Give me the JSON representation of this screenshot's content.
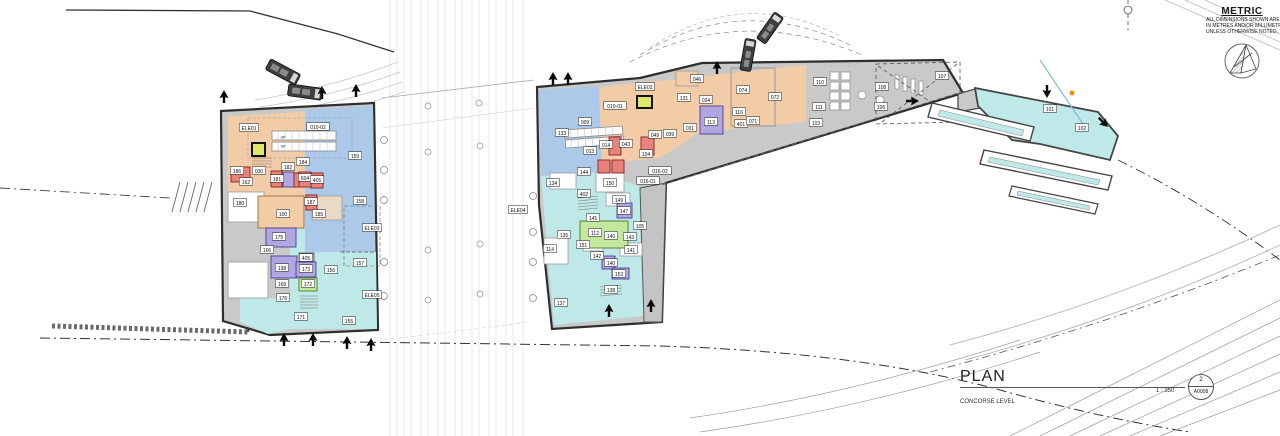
{
  "metric": {
    "title": "METRIC",
    "lines": [
      "ALL DIMENSIONS SHOWN ARE",
      "IN METRES AND/OR MILLIMETRES",
      "UNLESS OTHERWISE NOTED."
    ]
  },
  "title_block": {
    "title": "PLAN",
    "subtitle": "CONCORSE LEVEL",
    "scale": "1 : 350",
    "sheet_no": "2",
    "sheet_ref": "A0008"
  },
  "colors": {
    "salmon": "#f2cba7",
    "blue": "#adc9e9",
    "cyan": "#bfe8e9",
    "grey": "#c9c9c9",
    "red": "#e8837b",
    "purple": "#b2a6e2",
    "green": "#c4e79e",
    "yellow": "#dde76a",
    "greyroom": "#b5b5b5",
    "wall": "#2e2e2e"
  },
  "room_stroke": {
    "salmon": "#a06a3a",
    "red": "#8c1f1f",
    "purple": "#4a3f8f",
    "green": "#4c7a28",
    "yellow": "#111111",
    "cyan": "#3d8f96",
    "greyroom": "#666666",
    "blue": "#4a6f9f"
  },
  "labels": [
    {
      "t": "ELE01",
      "x": 249,
      "y": 128
    },
    {
      "t": "010-02",
      "x": 318,
      "y": 127
    },
    {
      "t": "UP",
      "x": 283,
      "y": 137,
      "fs": 3.5,
      "box": false
    },
    {
      "t": "UP",
      "x": 283,
      "y": 146,
      "fs": 3.5,
      "box": false
    },
    {
      "t": "159",
      "x": 355,
      "y": 156
    },
    {
      "t": "184",
      "x": 303,
      "y": 162
    },
    {
      "t": "182",
      "x": 288,
      "y": 167
    },
    {
      "t": "030",
      "x": 259,
      "y": 171
    },
    {
      "t": "186",
      "x": 237,
      "y": 171
    },
    {
      "t": "162",
      "x": 246,
      "y": 182
    },
    {
      "t": "181",
      "x": 277,
      "y": 179
    },
    {
      "t": "604",
      "x": 305,
      "y": 178
    },
    {
      "t": "405",
      "x": 317,
      "y": 180
    },
    {
      "t": "180",
      "x": 240,
      "y": 203
    },
    {
      "t": "187",
      "x": 311,
      "y": 202
    },
    {
      "t": "100",
      "x": 283,
      "y": 214
    },
    {
      "t": "185",
      "x": 319,
      "y": 214
    },
    {
      "t": "158",
      "x": 360,
      "y": 201
    },
    {
      "t": "175",
      "x": 279,
      "y": 237
    },
    {
      "t": "166",
      "x": 267,
      "y": 250
    },
    {
      "t": "198",
      "x": 282,
      "y": 268
    },
    {
      "t": "405",
      "x": 306,
      "y": 258
    },
    {
      "t": "173",
      "x": 306,
      "y": 269
    },
    {
      "t": "156",
      "x": 331,
      "y": 270
    },
    {
      "t": "157",
      "x": 360,
      "y": 263
    },
    {
      "t": "169",
      "x": 282,
      "y": 284
    },
    {
      "t": "172",
      "x": 308,
      "y": 284
    },
    {
      "t": "176",
      "x": 283,
      "y": 298
    },
    {
      "t": "171",
      "x": 301,
      "y": 317
    },
    {
      "t": "155",
      "x": 349,
      "y": 321
    },
    {
      "t": "ELE03",
      "x": 372,
      "y": 228
    },
    {
      "t": "ELE05",
      "x": 372,
      "y": 295
    },
    {
      "t": "ELE02",
      "x": 645,
      "y": 87
    },
    {
      "t": "010-01",
      "x": 615,
      "y": 106
    },
    {
      "t": "009",
      "x": 585,
      "y": 122
    },
    {
      "t": "133",
      "x": 562,
      "y": 133
    },
    {
      "t": "013",
      "x": 590,
      "y": 151
    },
    {
      "t": "014",
      "x": 606,
      "y": 145
    },
    {
      "t": "043",
      "x": 626,
      "y": 144
    },
    {
      "t": "049",
      "x": 655,
      "y": 135
    },
    {
      "t": "039",
      "x": 670,
      "y": 134
    },
    {
      "t": "031",
      "x": 690,
      "y": 128
    },
    {
      "t": "131",
      "x": 684,
      "y": 98
    },
    {
      "t": "034",
      "x": 706,
      "y": 100
    },
    {
      "t": "046",
      "x": 697,
      "y": 79
    },
    {
      "t": "074",
      "x": 743,
      "y": 90
    },
    {
      "t": "072",
      "x": 775,
      "y": 97
    },
    {
      "t": "110",
      "x": 820,
      "y": 82
    },
    {
      "t": "111",
      "x": 819,
      "y": 107
    },
    {
      "t": "103",
      "x": 816,
      "y": 123
    },
    {
      "t": "116",
      "x": 739,
      "y": 112
    },
    {
      "t": "401",
      "x": 741,
      "y": 124
    },
    {
      "t": "071",
      "x": 753,
      "y": 121
    },
    {
      "t": "113",
      "x": 711,
      "y": 122
    },
    {
      "t": "108",
      "x": 882,
      "y": 87
    },
    {
      "t": "106",
      "x": 881,
      "y": 107
    },
    {
      "t": "107",
      "x": 942,
      "y": 76
    },
    {
      "t": "104",
      "x": 646,
      "y": 154
    },
    {
      "t": "016-02",
      "x": 660,
      "y": 171
    },
    {
      "t": "016-01",
      "x": 648,
      "y": 181
    },
    {
      "t": "134",
      "x": 553,
      "y": 183
    },
    {
      "t": "144",
      "x": 584,
      "y": 172
    },
    {
      "t": "402",
      "x": 584,
      "y": 194
    },
    {
      "t": "150",
      "x": 610,
      "y": 183
    },
    {
      "t": "149",
      "x": 619,
      "y": 200
    },
    {
      "t": "145",
      "x": 593,
      "y": 218
    },
    {
      "t": "147",
      "x": 624,
      "y": 211
    },
    {
      "t": "105",
      "x": 640,
      "y": 226
    },
    {
      "t": "135",
      "x": 564,
      "y": 235
    },
    {
      "t": "112",
      "x": 595,
      "y": 233
    },
    {
      "t": "146",
      "x": 611,
      "y": 236
    },
    {
      "t": "143",
      "x": 630,
      "y": 237
    },
    {
      "t": "151",
      "x": 583,
      "y": 245
    },
    {
      "t": "141",
      "x": 631,
      "y": 250
    },
    {
      "t": "142",
      "x": 597,
      "y": 256
    },
    {
      "t": "140",
      "x": 611,
      "y": 263
    },
    {
      "t": "153",
      "x": 619,
      "y": 274
    },
    {
      "t": "114",
      "x": 550,
      "y": 249
    },
    {
      "t": "138",
      "x": 611,
      "y": 290
    },
    {
      "t": "137",
      "x": 561,
      "y": 303
    },
    {
      "t": "ELE04",
      "x": 518,
      "y": 210
    },
    {
      "t": "101",
      "x": 1050,
      "y": 109
    },
    {
      "t": "102",
      "x": 1082,
      "y": 128
    }
  ],
  "colored_rooms": [
    {
      "x": 231,
      "y": 167,
      "w": 19,
      "h": 15,
      "c": "red"
    },
    {
      "x": 271,
      "y": 171,
      "w": 11,
      "h": 16,
      "c": "red"
    },
    {
      "x": 283,
      "y": 172,
      "w": 11,
      "h": 15,
      "c": "purple"
    },
    {
      "x": 294,
      "y": 173,
      "w": 6,
      "h": 14,
      "c": "red"
    },
    {
      "x": 299,
      "y": 172,
      "w": 12,
      "h": 15,
      "c": "red"
    },
    {
      "x": 311,
      "y": 173,
      "w": 12,
      "h": 15,
      "c": "red"
    },
    {
      "x": 306,
      "y": 195,
      "w": 11,
      "h": 15,
      "c": "red"
    },
    {
      "x": 258,
      "y": 196,
      "w": 46,
      "h": 32,
      "c": "salmon"
    },
    {
      "x": 266,
      "y": 228,
      "w": 30,
      "h": 19,
      "c": "purple"
    },
    {
      "x": 271,
      "y": 256,
      "w": 26,
      "h": 22,
      "c": "purple"
    },
    {
      "x": 296,
      "y": 262,
      "w": 20,
      "h": 15,
      "c": "purple"
    },
    {
      "x": 299,
      "y": 253,
      "w": 15,
      "h": 8,
      "c": "greyroom"
    },
    {
      "x": 299,
      "y": 278,
      "w": 18,
      "h": 13,
      "c": "green"
    },
    {
      "x": 252,
      "y": 143,
      "w": 13,
      "h": 13,
      "c": "yellow"
    },
    {
      "x": 609,
      "y": 137,
      "w": 12,
      "h": 18,
      "c": "red"
    },
    {
      "x": 641,
      "y": 137,
      "w": 13,
      "h": 18,
      "c": "red"
    },
    {
      "x": 598,
      "y": 160,
      "w": 12,
      "h": 13,
      "c": "red"
    },
    {
      "x": 612,
      "y": 160,
      "w": 12,
      "h": 13,
      "c": "red"
    },
    {
      "x": 700,
      "y": 106,
      "w": 23,
      "h": 28,
      "c": "purple"
    },
    {
      "x": 617,
      "y": 203,
      "w": 15,
      "h": 15,
      "c": "purple"
    },
    {
      "x": 602,
      "y": 256,
      "w": 13,
      "h": 13,
      "c": "purple"
    },
    {
      "x": 612,
      "y": 268,
      "w": 17,
      "h": 11,
      "c": "purple"
    },
    {
      "x": 580,
      "y": 221,
      "w": 48,
      "h": 27,
      "c": "green"
    },
    {
      "x": 637,
      "y": 96,
      "w": 15,
      "h": 12,
      "c": "yellow"
    }
  ],
  "arrows": [
    {
      "x": 224,
      "y": 97,
      "r": 0
    },
    {
      "x": 322,
      "y": 93,
      "r": 0
    },
    {
      "x": 356,
      "y": 91,
      "r": 0
    },
    {
      "x": 284,
      "y": 340,
      "r": 0
    },
    {
      "x": 313,
      "y": 340,
      "r": 0
    },
    {
      "x": 347,
      "y": 343,
      "r": 0
    },
    {
      "x": 371,
      "y": 345,
      "r": 0
    },
    {
      "x": 553,
      "y": 79,
      "r": 0
    },
    {
      "x": 568,
      "y": 79,
      "r": 0
    },
    {
      "x": 717,
      "y": 68,
      "r": 0
    },
    {
      "x": 609,
      "y": 311,
      "r": 0
    },
    {
      "x": 651,
      "y": 306,
      "r": 0
    },
    {
      "x": 912,
      "y": 101,
      "r": 90
    },
    {
      "x": 1047,
      "y": 91,
      "r": 180
    },
    {
      "x": 1103,
      "y": 122,
      "r": 135
    }
  ]
}
